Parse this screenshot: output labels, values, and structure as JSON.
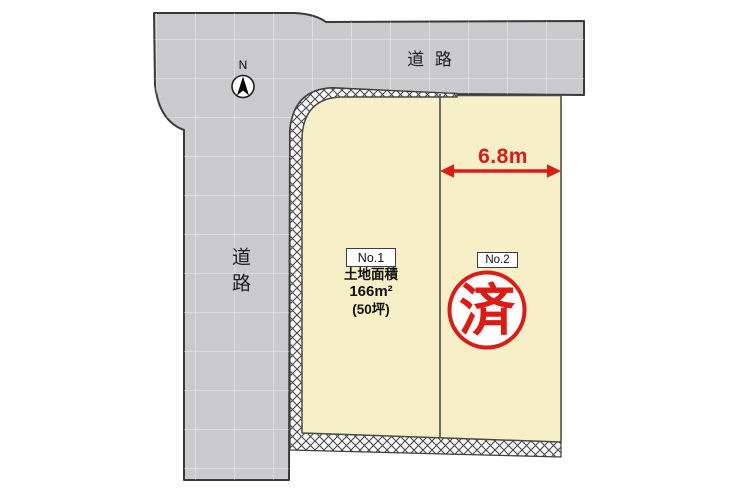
{
  "diagram": {
    "type": "land-plot-site-plan",
    "roads": {
      "top_label": "道 路",
      "left_label": "道路"
    },
    "compass": {
      "north_label": "N"
    },
    "plots": {
      "no1": {
        "number": "No.1",
        "area_title": "土地面積",
        "area_sqm": "166m²",
        "area_tsubo": "(50坪)"
      },
      "no2": {
        "number": "No.2",
        "sold_stamp": "済"
      }
    },
    "dimension": {
      "width_label": "6.8m"
    },
    "colors": {
      "road_fill": "#cacacc",
      "road_outline": "#39393b",
      "plot_fill": "#f6efc8",
      "plot_outline": "#4a4a42",
      "accent_red": "#de1a12",
      "background": "#ffffff"
    }
  }
}
